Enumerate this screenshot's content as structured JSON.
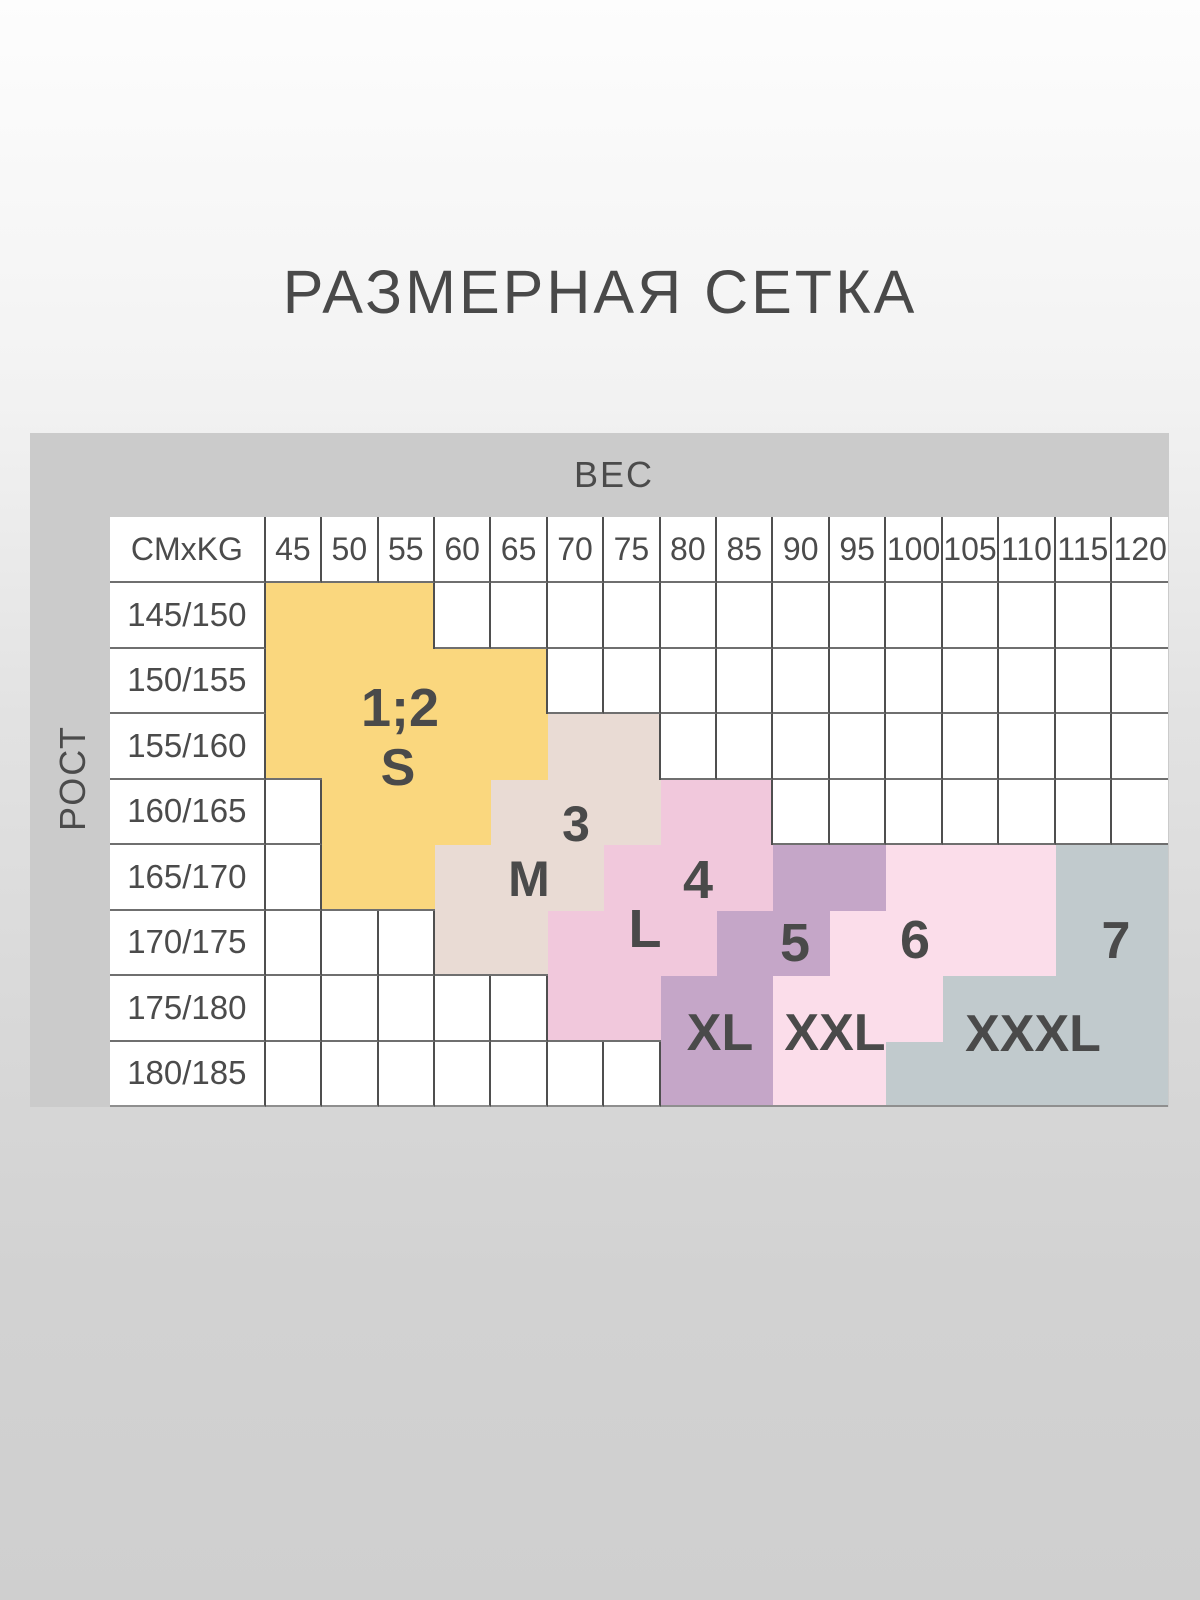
{
  "title": "РАЗМЕРНАЯ СЕТКА",
  "axes": {
    "weight": "ВЕС",
    "height": "РОСТ"
  },
  "grid": {
    "corner_label": "CMxKG",
    "weight_columns": [
      "45",
      "50",
      "55",
      "60",
      "65",
      "70",
      "75",
      "80",
      "85",
      "90",
      "95",
      "100",
      "105",
      "110",
      "115",
      "120"
    ],
    "height_rows": [
      "145/150",
      "150/155",
      "155/160",
      "160/165",
      "165/170",
      "170/175",
      "175/180",
      "180/185"
    ]
  },
  "colors": {
    "band": "#cbcbcb",
    "cell_background": "#ffffff",
    "grid_line_vertical": "#4f4f4f",
    "grid_line_horizontal": "#6f6f6f",
    "text": "#4b4b4b",
    "size_s": "#fad77e",
    "size_m": "#e9dbd4",
    "size_l": "#f1c8dc",
    "size_xl": "#c5a6c8",
    "size_xxl": "#fbddea",
    "size_xxxl": "#c1cacd"
  },
  "chart_data": {
    "type": "heatmap",
    "title": "РАЗМЕРНАЯ СЕТКА",
    "xlabel": "ВЕС",
    "ylabel": "РОСТ",
    "corner_units": "CMxKG",
    "x": [
      45,
      50,
      55,
      60,
      65,
      70,
      75,
      80,
      85,
      90,
      95,
      100,
      105,
      110,
      115,
      120
    ],
    "y": [
      "145/150",
      "150/155",
      "155/160",
      "160/165",
      "165/170",
      "170/175",
      "175/180",
      "180/185"
    ],
    "legend_position": "none",
    "grid": true,
    "series": [
      {
        "name": "size-1-2-S",
        "number": "1;2",
        "size": "S",
        "color": "#fad77e",
        "cells": [
          {
            "height": "145/150",
            "w_min": 45,
            "w_max": 55
          },
          {
            "height": "150/155",
            "w_min": 45,
            "w_max": 65
          },
          {
            "height": "155/160",
            "w_min": 45,
            "w_max": 65
          },
          {
            "height": "160/165",
            "w_min": 50,
            "w_max": 60
          },
          {
            "height": "165/170",
            "w_min": 50,
            "w_max": 55
          }
        ],
        "labels": [
          {
            "text": "1;2",
            "x": 400,
            "y": 708,
            "font_px": 54
          },
          {
            "text": "S",
            "x": 398,
            "y": 768,
            "font_px": 52
          }
        ]
      },
      {
        "name": "size-3-M",
        "number": "3",
        "size": "M",
        "color": "#e9dbd4",
        "cells": [
          {
            "height": "155/160",
            "w_min": 70,
            "w_max": 75
          },
          {
            "height": "160/165",
            "w_min": 65,
            "w_max": 75
          },
          {
            "height": "165/170",
            "w_min": 60,
            "w_max": 70
          },
          {
            "height": "170/175",
            "w_min": 60,
            "w_max": 65
          }
        ],
        "labels": [
          {
            "text": "3",
            "x": 576,
            "y": 824,
            "font_px": 50
          },
          {
            "text": "M",
            "x": 529,
            "y": 879,
            "font_px": 50
          }
        ]
      },
      {
        "name": "size-4-L",
        "number": "4",
        "size": "L",
        "color": "#f1c8dc",
        "cells": [
          {
            "height": "160/165",
            "w_min": 80,
            "w_max": 85
          },
          {
            "height": "165/170",
            "w_min": 75,
            "w_max": 85
          },
          {
            "height": "170/175",
            "w_min": 70,
            "w_max": 80
          },
          {
            "height": "175/180",
            "w_min": 70,
            "w_max": 75
          }
        ],
        "labels": [
          {
            "text": "4",
            "x": 698,
            "y": 880,
            "font_px": 54
          },
          {
            "text": "L",
            "x": 645,
            "y": 929,
            "font_px": 54
          }
        ]
      },
      {
        "name": "size-5-XL",
        "number": "5",
        "size": "XL",
        "color": "#c5a6c8",
        "cells": [
          {
            "height": "165/170",
            "w_min": 90,
            "w_max": 95
          },
          {
            "height": "170/175",
            "w_min": 85,
            "w_max": 90
          },
          {
            "height": "175/180",
            "w_min": 80,
            "w_max": 85
          },
          {
            "height": "180/185",
            "w_min": 80,
            "w_max": 85
          }
        ],
        "labels": [
          {
            "text": "5",
            "x": 795,
            "y": 943,
            "font_px": 54
          },
          {
            "text": "XL",
            "x": 720,
            "y": 1033,
            "font_px": 52
          }
        ]
      },
      {
        "name": "size-6-XXL",
        "number": "6",
        "size": "XXL",
        "color": "#fbddea",
        "cells": [
          {
            "height": "165/170",
            "w_min": 100,
            "w_max": 110
          },
          {
            "height": "170/175",
            "w_min": 95,
            "w_max": 110
          },
          {
            "height": "175/180",
            "w_min": 90,
            "w_max": 100
          },
          {
            "height": "180/185",
            "w_min": 90,
            "w_max": 95
          }
        ],
        "labels": [
          {
            "text": "6",
            "x": 915,
            "y": 940,
            "font_px": 54
          },
          {
            "text": "XXL",
            "x": 835,
            "y": 1033,
            "font_px": 52
          }
        ]
      },
      {
        "name": "size-7-XXXL",
        "number": "7",
        "size": "XXXL",
        "color": "#c1cacd",
        "cells": [
          {
            "height": "165/170",
            "w_min": 115,
            "w_max": 120
          },
          {
            "height": "170/175",
            "w_min": 115,
            "w_max": 120
          },
          {
            "height": "175/180",
            "w_min": 105,
            "w_max": 120
          },
          {
            "height": "180/185",
            "w_min": 100,
            "w_max": 120
          }
        ],
        "labels": [
          {
            "text": "7",
            "x": 1116,
            "y": 941,
            "font_px": 52
          },
          {
            "text": "XXXL",
            "x": 1033,
            "y": 1034,
            "font_px": 52
          }
        ]
      }
    ]
  }
}
